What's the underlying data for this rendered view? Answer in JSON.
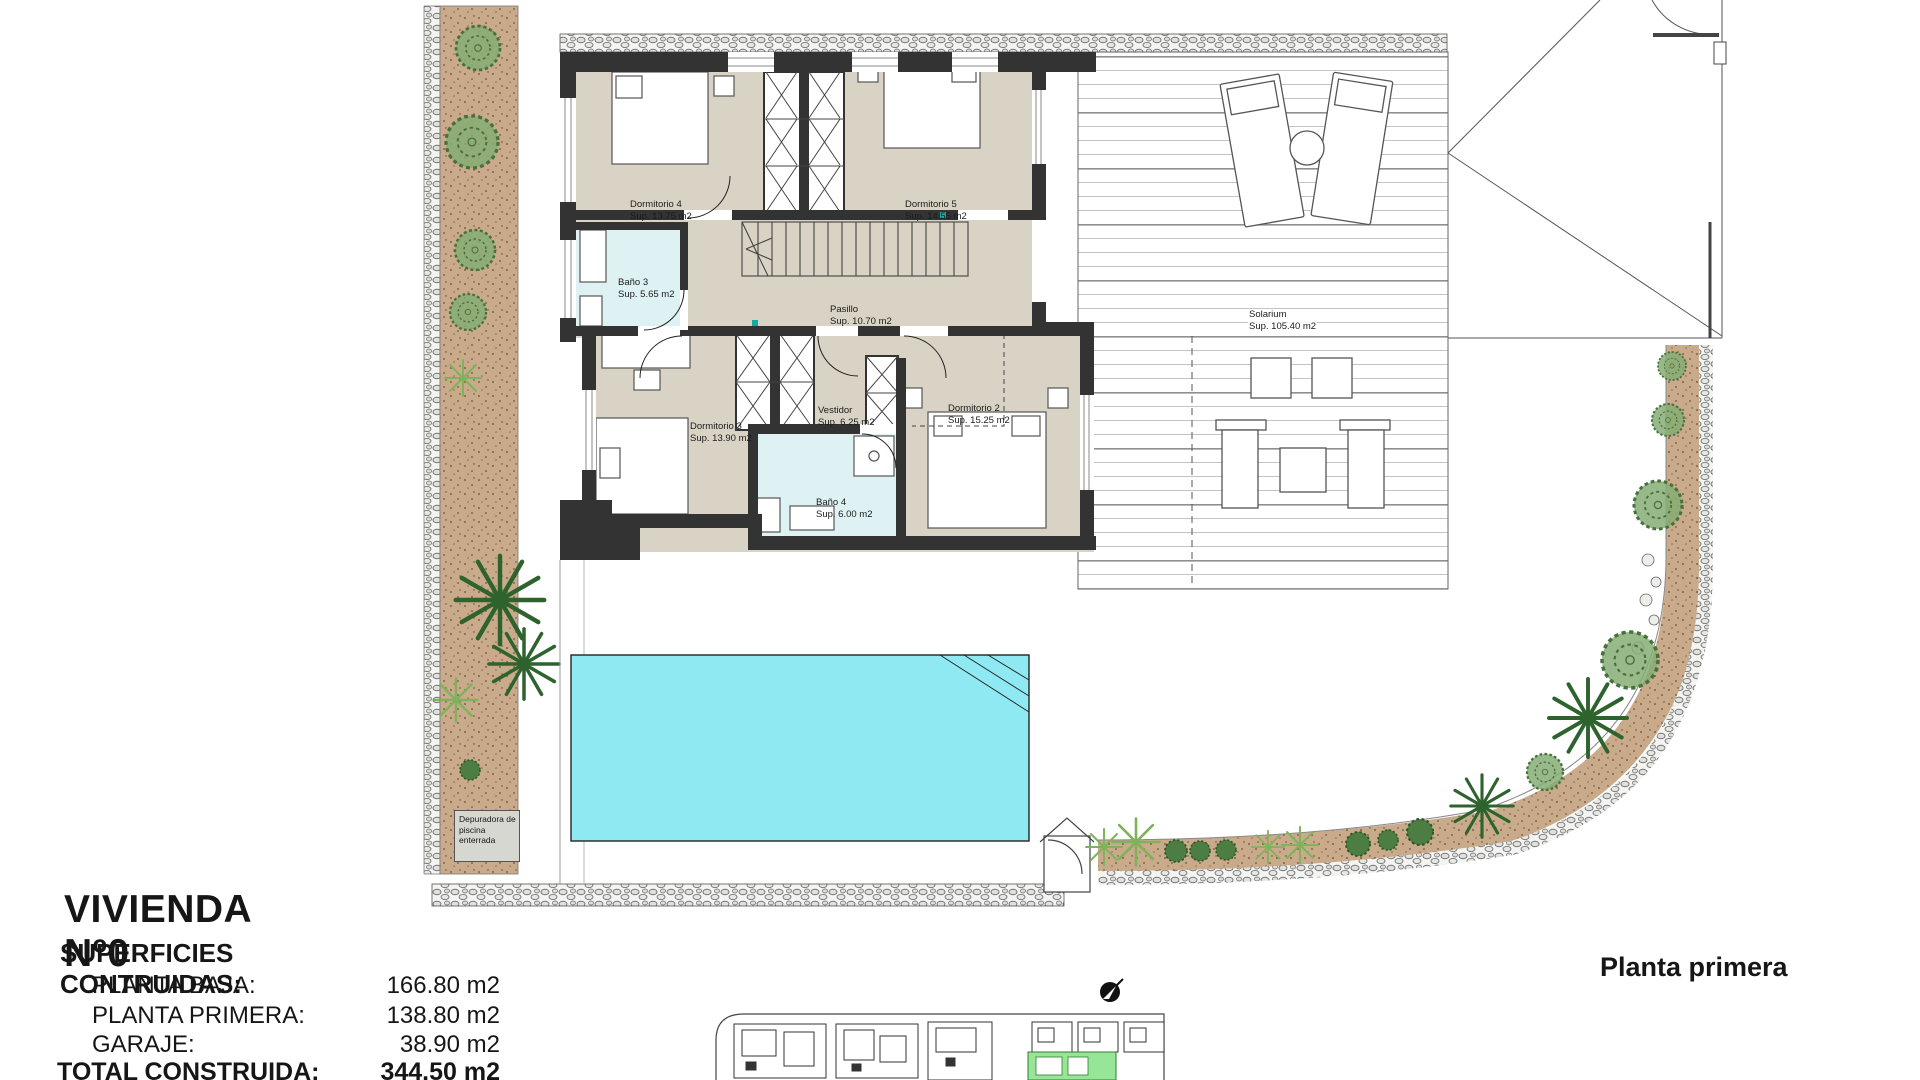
{
  "plan": {
    "floor_label": "Planta primera"
  },
  "rooms": {
    "dormitorio4": {
      "name": "Dormitorio 4",
      "area": "Sup. 13.75 m2"
    },
    "dormitorio5": {
      "name": "Dormitorio 5",
      "area": "Sup. 14.55 m2"
    },
    "bano3": {
      "name": "Baño 3",
      "area": "Sup. 5.65 m2"
    },
    "pasillo": {
      "name": "Pasillo",
      "area": "Sup. 10.70 m2"
    },
    "dormitorio3": {
      "name": "Dormitorio 3",
      "area": "Sup. 13.90 m2"
    },
    "vestidor": {
      "name": "Vestidor",
      "area": "Sup. 6.25 m2"
    },
    "dormitorio2": {
      "name": "Dormitorio 2",
      "area": "Sup. 15.25 m2"
    },
    "bano4": {
      "name": "Baño 4",
      "area": "Sup. 6.00 m2"
    },
    "solarium": {
      "name": "Solarium",
      "area": "Sup. 105.40 m2"
    }
  },
  "annotations": {
    "pool_equipment": "Depuradora de piscina enterrada"
  },
  "title_block": {
    "title": "VIVIENDA Nº0",
    "subtitle": "SUPERFICIES CONTRUIDAS:",
    "items": [
      {
        "label": "PLANTA BAJA:",
        "value": "166.80 m2"
      },
      {
        "label": "PLANTA PRIMERA:",
        "value": "138.80 m2"
      },
      {
        "label": "GARAJE:",
        "value": "38.90 m2"
      }
    ],
    "total_label": "TOTAL CONSTRUIDA:",
    "total_value": "344.50 m2"
  },
  "colors": {
    "wall": "#333333",
    "floor": "#d8d3c4",
    "bath": "#def2f4",
    "pool": "#8ee9f3",
    "garden": "#c9ab8c",
    "plant": "#2e632e",
    "highlight_unit": "#97e697",
    "accent": "#19a7a0"
  }
}
